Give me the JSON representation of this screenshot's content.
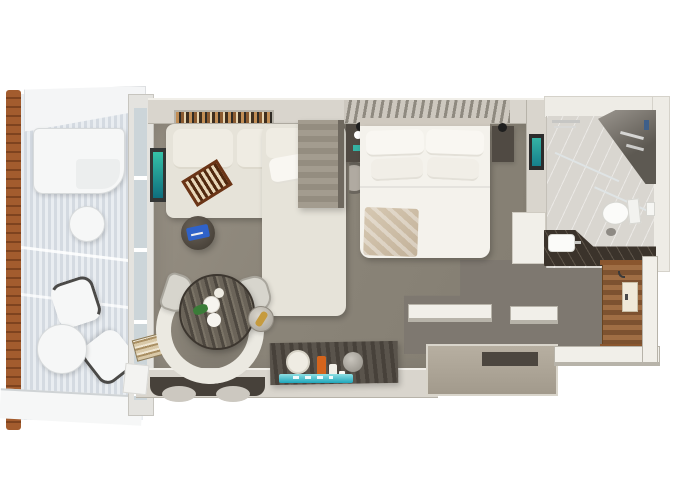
{
  "meta": {
    "type": "floor-plan-render",
    "description": "top-down 3d rendering of a suite with balcony, living area, bedroom, bathroom and entry; no text labels visible"
  },
  "regions": {
    "balcony": "balcony",
    "living": "living-area",
    "bedroom": "bedroom",
    "bathroom": "bathroom",
    "entry": "entry-corridor"
  },
  "furniture": [
    "balcony-wood-railing",
    "balcony-sun-lounger",
    "balcony-side-table",
    "balcony-chair",
    "balcony-cocktail-table",
    "sliding-glass-door",
    "wall-tv",
    "bookshelf",
    "l-shaped-sofa",
    "chaise-lounge",
    "backgammon-board",
    "round-side-table",
    "tablet",
    "dining-table",
    "curved-banquette",
    "dining-chair",
    "champagne-bucket",
    "minibar-console",
    "drinks-tray",
    "ice-bucket",
    "divider-cabinet",
    "stool",
    "coffee-nightstand",
    "king-bed",
    "pillow",
    "throw-blanket",
    "nightstand",
    "reading-lamp",
    "wall-art",
    "walk-in-shower",
    "shower-fixtures",
    "glass-partition",
    "towel-rail",
    "toilet",
    "toilet-paper-holder",
    "vanity-counter",
    "sink",
    "entry-door",
    "wood-flooring",
    "wardrobe",
    "magazine-stack"
  ],
  "palette": {
    "bg": "#ffffff",
    "wood-rail": "#a35c2e",
    "wood-rail-dark": "#7e431f",
    "deck-light": "#e9edf1",
    "deck-mid": "#d4dae1",
    "awning": "#f4f5f6",
    "white-furn": "#f6f7f7",
    "furn-shadow": "#d7dadb",
    "chair-arm": "#4b4a48",
    "glass": "#ccd5d9",
    "frame": "#e4e3df",
    "wall": "#d9d5cd",
    "wall-light": "#f1efe9",
    "wall-dark": "#b7b3a9",
    "floor-a": "#968f83",
    "floor-b": "#837d71",
    "floor-entry": "#7e7870",
    "shelf-dark": "#2f2b25",
    "book-a": "#c28e55",
    "book-b": "#8a5a30",
    "book-c": "#e6d3ae",
    "book-d": "#3f2f1f",
    "slat-a": "#cdc8bf",
    "slat-b": "#8f8a80",
    "tv-frame": "#343635",
    "tv-a": "#35c2a8",
    "tv-b": "#0e6e7e",
    "sofa": "#e6e3d9",
    "sofa-cushion": "#efece3",
    "pillow": "#f9f7f2",
    "pillow-dim": "#f1eee7",
    "bgammon-a": "#e7d6b8",
    "bgammon-b": "#50290f",
    "bgammon-frame": "#6b3517",
    "tbl-a": "#6a6258",
    "tbl-b": "#3e3830",
    "tablet": "#2f62c9",
    "woodtbl-a": "#6b6459",
    "woodtbl-b": "#4e4840",
    "woodtbl-c": "#7a7366",
    "banquette": "#ebe9e1",
    "chair-grey": "#d7d5cd",
    "chair-grey-line": "#a9a69d",
    "plate": "#f6f4ef",
    "garnish": "#3a7c38",
    "gold": "#c69b3e",
    "metal-a": "#d9d5cc",
    "metal-b": "#a29d93",
    "console-a": "#5a544c",
    "console-b": "#47413a",
    "orange": "#d4641c",
    "tealtray-a": "#8edfe3",
    "tealtray-b": "#1fa6bb",
    "bed": "#f4f2ec",
    "headboard": "#cfc9bf",
    "throw-a": "#d6c8b2",
    "throw-b": "#c3b29a",
    "nstand": "#504a43",
    "lamp": "#1f1f1f",
    "cab-a": "#a39c8f",
    "cab-b": "#948d80",
    "cab-side": "#6f695f",
    "stool": "#b0aaa1",
    "stool-line": "#6b665e",
    "art-frame": "#2c2c2c",
    "art-a": "#35b3a4",
    "art-b": "#167f8c",
    "bath-wall": "#eeece6",
    "bath-floor": "#d9d6d0",
    "marble-a": "#9b968f",
    "marble-b": "#5d5952",
    "fixture": "#d6d6d4",
    "glassline": "#dfe4e5",
    "porcelain": "#fbfbf9",
    "porcelain-line": "#d6d6d1",
    "counter": "#3b332b",
    "woodfloor-a": "#a06e44",
    "woodfloor-b": "#7d5230",
    "threshold": "#8a562e",
    "door-panel": "#f0ead9",
    "door-frame": "#c9bfa6",
    "wardrobe-a": "#b7afa1",
    "wardrobe-b": "#a29a8c",
    "slot": "#4c463f",
    "mag-a": "#d9c9a8",
    "mag-b": "#a98f63",
    "mag-c": "#efe6d2"
  }
}
